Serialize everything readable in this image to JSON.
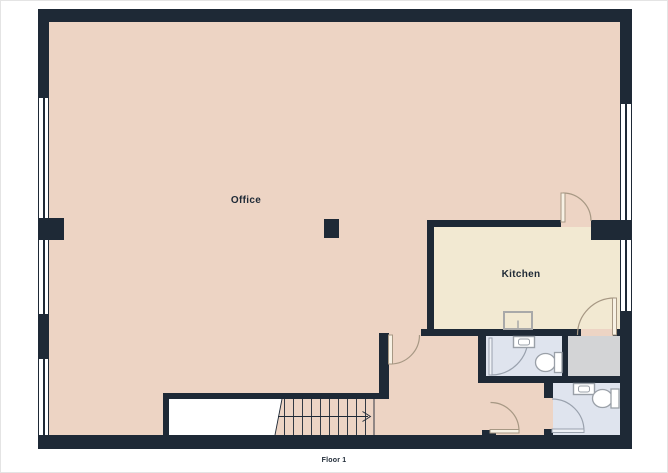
{
  "floorplan": {
    "floor_label": "Floor 1",
    "rooms": {
      "office": {
        "label": "Office"
      },
      "kitchen": {
        "label": "Kitchen"
      }
    },
    "colors": {
      "wall": "#1e2936",
      "office_floor": "#edd4c4",
      "kitchen_floor": "#f2e9d2",
      "bathroom_floor": "#dfe4ee",
      "storage_floor": "#d3d4d6",
      "stair_void": "#ffffff",
      "door_warm": "#a79884",
      "door_cool": "#99a1ad",
      "fixture": "#9aa0a8",
      "text": "#1e2936",
      "background": "#ffffff",
      "page_border": "#e4e4e4"
    }
  }
}
